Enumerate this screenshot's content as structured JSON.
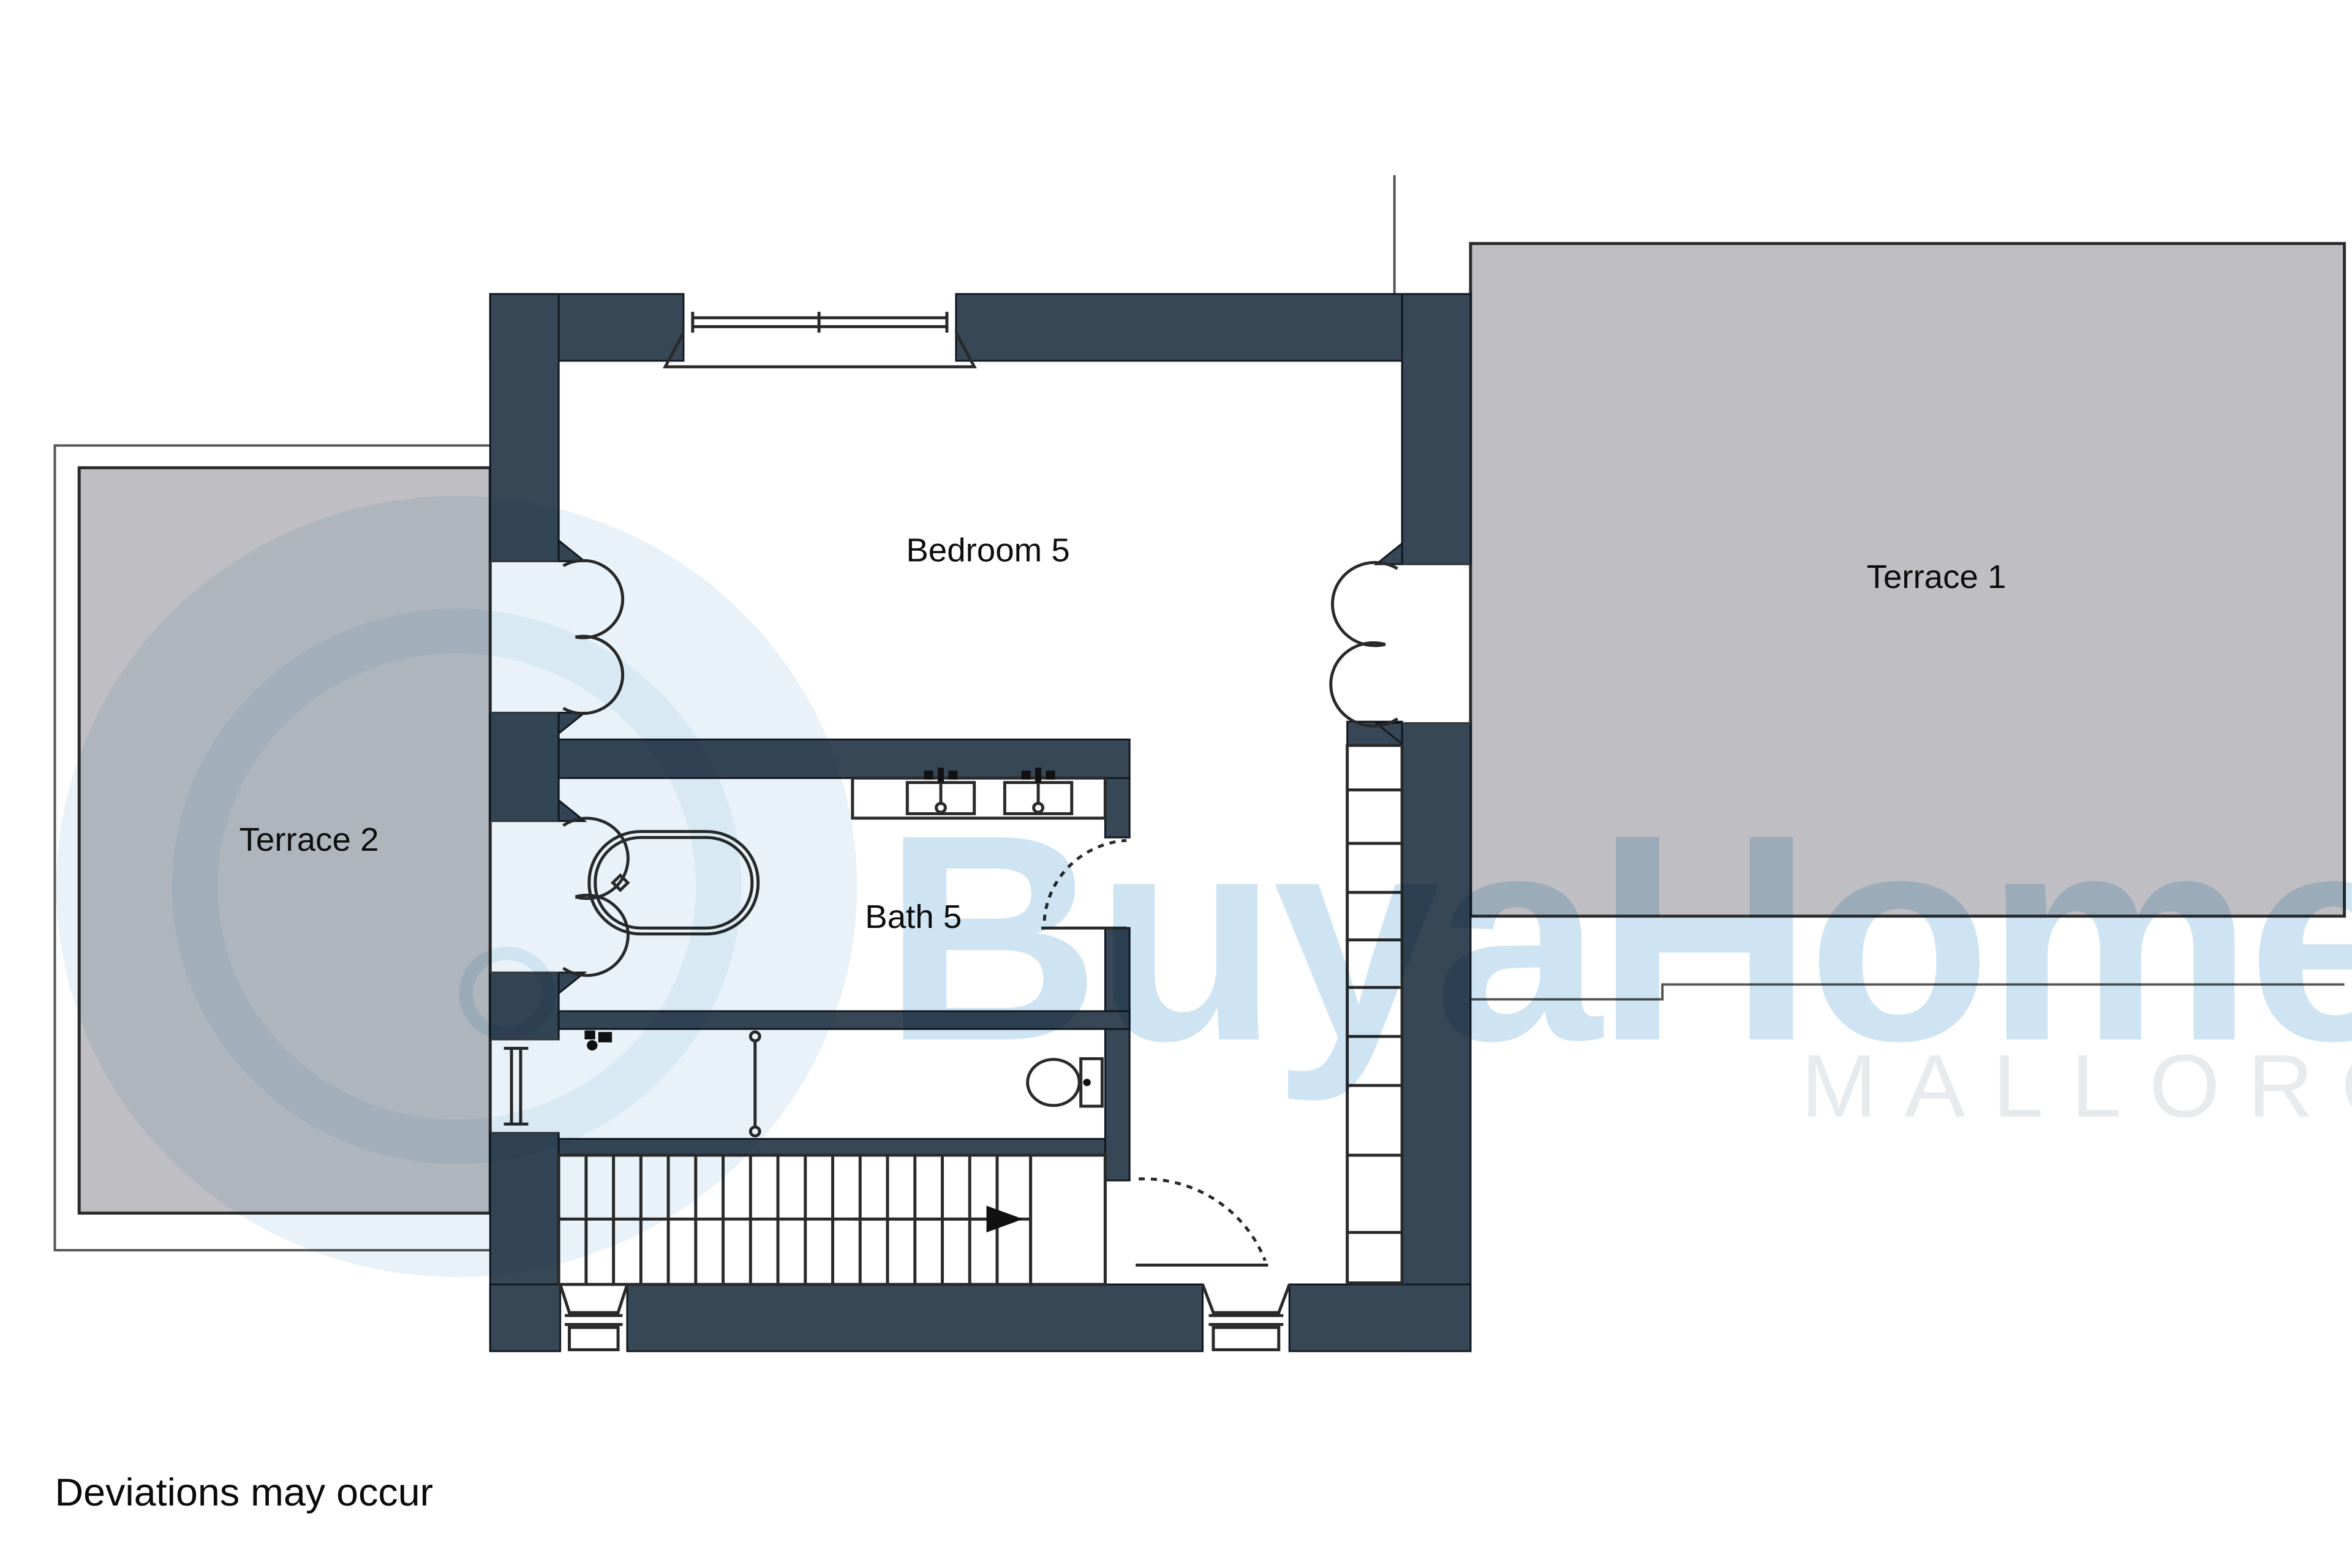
{
  "plan": {
    "title_context": "floor-plan",
    "rooms": {
      "bedroom5": "Bedroom 5",
      "bath5": "Bath 5",
      "terrace1": "Terrace 1",
      "terrace2": "Terrace 2"
    },
    "footnote": "Deviations may occur",
    "watermark": {
      "brand": "BuyaHome",
      "region": "MALLORCA"
    },
    "colors": {
      "wall": "#374756",
      "terrace_fill": "#bfbfc3",
      "terrace_outline": "#2b2b2b",
      "line": "#2a2a2a",
      "watermark_blue": "#cfe4f3",
      "watermark_circle": "#e9f2f8",
      "watermark_gray": "#e8ebee",
      "background": "#ffffff"
    }
  }
}
